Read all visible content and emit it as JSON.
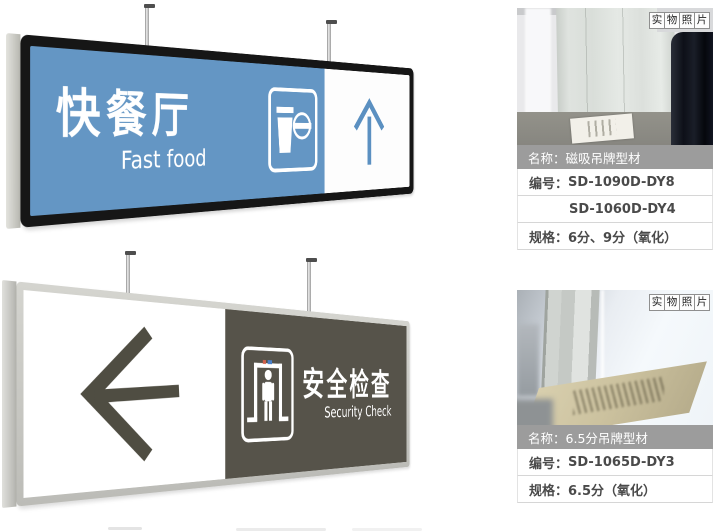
{
  "signs": {
    "fast_food": {
      "title": "快餐厅",
      "subtitle": "Fast food",
      "icon": "drink-and-burger-icon",
      "arrow_direction": "up",
      "panel_color": "#6496c4",
      "frame_color": "#161616",
      "arrow_color": "#5b90c1"
    },
    "security": {
      "title": "安全检查",
      "subtitle": "Security Check",
      "icon": "security-scanner-icon",
      "arrow_direction": "left",
      "panel_color": "#56534a",
      "frame_color": "#c8c8c3",
      "arrow_color": "#4f4d42"
    }
  },
  "products": [
    {
      "badge_chars": [
        "实",
        "物",
        "照",
        "片"
      ],
      "rows": [
        {
          "label": "名称：",
          "value": "磁吸吊牌型材"
        },
        {
          "label": "编号：",
          "value": "SD-1090D-DY8"
        },
        {
          "label": "",
          "value": "SD-1060D-DY4"
        },
        {
          "label": "规格：",
          "value": "6分、9分（氧化）"
        }
      ]
    },
    {
      "badge_chars": [
        "实",
        "物",
        "照",
        "片"
      ],
      "rows": [
        {
          "label": "名称：",
          "value": "6.5分吊牌型材"
        },
        {
          "label": "编号：",
          "value": "SD-1065D-DY3"
        },
        {
          "label": "规格：",
          "value": "6.5分（氧化）"
        }
      ]
    }
  ],
  "colors": {
    "header_row_bg": "#9c9c9c",
    "row_text": "#4a4a4a",
    "fast_food_blue": "#6496c4",
    "security_olive": "#56534a"
  }
}
